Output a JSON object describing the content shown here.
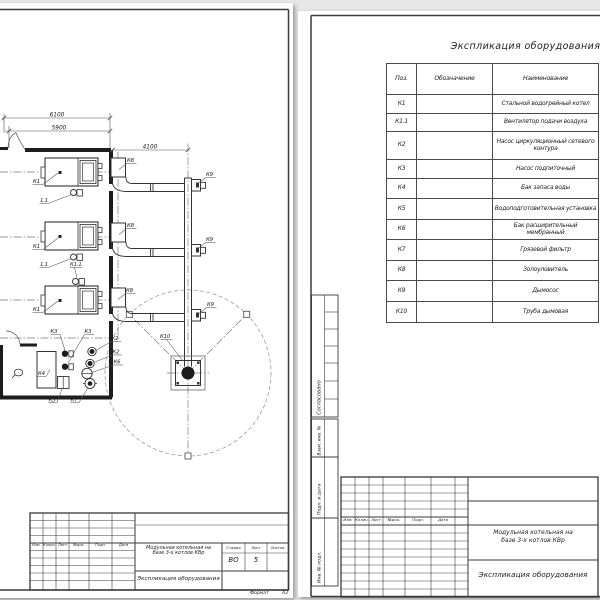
{
  "sheet_left": {
    "dimensions": {
      "overall_width": "6100",
      "inner_width": "5900",
      "chimney_offset": "4100"
    },
    "plan_labels": {
      "boiler1": "К1",
      "boiler2": "К1",
      "boiler3": "К1",
      "fan1": "1.1",
      "fan2": "1.1",
      "fan3": "К1.1",
      "ash1": "К8",
      "ash2": "К8",
      "ash3": "К8",
      "exhauster1": "К9",
      "exhauster2": "К9",
      "exhauster3": "К9",
      "chimney": "К10",
      "makeup_pump1": "К3",
      "makeup_pump2": "К3",
      "circ_pump1": "К2",
      "circ_pump2": "К2",
      "expansion_tank": "К6",
      "storage_tank": "К4",
      "water_treatment": "К5",
      "mud_filter": "К7"
    },
    "title_block": {
      "col_izm": "Изм.",
      "col_kolich": "Колич.",
      "col_list": "Лист",
      "col_ndok": "№док.",
      "col_podp": "Подп.",
      "col_data": "Дата",
      "project_line1": "Модульная котельная на",
      "project_line2": "базе 3-х котлов КВр",
      "doc_name": "Экспликация оборудования",
      "stage_label": "Стадия",
      "sheet_label": "Лист",
      "sheets_label": "Листов",
      "stage_value": "ВО",
      "sheet_value": "5",
      "sheets_value": ""
    },
    "format_label": "Формат",
    "format_value": "А3"
  },
  "sheet_right": {
    "table": {
      "title": "Экспликация оборудования",
      "col_pos": "Поз.",
      "col_designation": "Обозначение",
      "col_name": "Наименование",
      "rows": [
        {
          "pos": "К1",
          "designation": "",
          "name": "Стальной водогрейный котел"
        },
        {
          "pos": "К1.1",
          "designation": "",
          "name": "Вентилятор подачи воздуха"
        },
        {
          "pos": "К2",
          "designation": "",
          "name": "Насос циркуляционный сетевого контура"
        },
        {
          "pos": "К3",
          "designation": "",
          "name": "Насос подпиточный"
        },
        {
          "pos": "К4",
          "designation": "",
          "name": "Бак запаса воды"
        },
        {
          "pos": "К5",
          "designation": "",
          "name": "Водоподготовительная установка"
        },
        {
          "pos": "К6",
          "designation": "",
          "name": "Бак расширительный мембранный"
        },
        {
          "pos": "К7",
          "designation": "",
          "name": "Грязевой фильтр"
        },
        {
          "pos": "К8",
          "designation": "",
          "name": "Золоуловитель"
        },
        {
          "pos": "К9",
          "designation": "",
          "name": "Дымосос"
        },
        {
          "pos": "К10",
          "designation": "",
          "name": "Труба дымовая"
        }
      ]
    },
    "margin_labels": {
      "soglasovano": "Согласовано",
      "vzam": "Взам. инв. №",
      "podp_data": "Подп. и дата",
      "inv_podl": "Инв. № подл."
    },
    "title_block": {
      "col_izm": "Изм.",
      "col_kolich": "Колич.",
      "col_list": "Лист",
      "col_ndok": "№док.",
      "col_podp": "Подп.",
      "col_data": "Дата",
      "project_line1": "Модульная котельная на",
      "project_line2": "базе 3-х котлов КВр",
      "doc_name": "Экспликация оборудования"
    }
  }
}
